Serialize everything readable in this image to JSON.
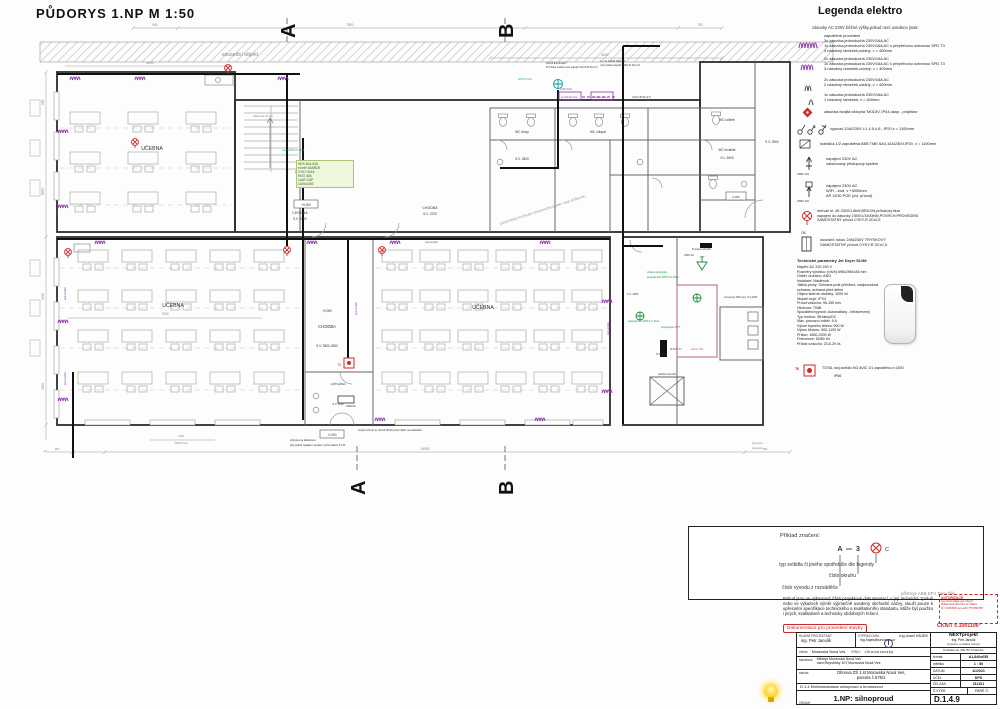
{
  "title": "PŮDORYS 1.NP  M 1:50",
  "plan": {
    "neighbor": "sousední objekt",
    "marker_a": "A",
    "marker_b": "B",
    "rooms": {
      "ucebna": "UČEBNA",
      "chodba": "CHODBA",
      "sv3300": "S.V. 3300",
      "sv3700": "S.V. 3700",
      "sv3839": "S.V. 3800-3900",
      "sv3000": "S.V. 3000",
      "sv2800": "S.V. 2800",
      "sv2600": "S.v. 2600",
      "sv2500": "S.V. 2500",
      "sv4000": "S.V. 4000",
      "wc_divky": "WC dívky",
      "wc_chlapci": "WC chlapci",
      "wc_ucitele": "WC učitelé",
      "wc_invalide": "WC invalidé",
      "umyvarna": "UMÝVÁRNA",
      "sklad": "sklad pod schody",
      "sachta": "šachta rozvodů",
      "ailona": "Ailona 750",
      "server": "serverový R26 stoj. S.V.2300"
    },
    "levels": {
      "zero": "+0,000",
      "minus": "-0,500",
      "plus": "0,060"
    },
    "notes": {
      "vent": "ODVĚTRÁNÍ POTRUBÍ VZDUCHOTECHNIKY NAD STŘECHU",
      "vana": "vana HDTV-U 16x2",
      "hds": "HDS 40A-63A\nel.měř 40A/B/3f\nCYKY 5x16\nHDO 40A\n1xAP-CAP\n1100x1400",
      "sup1": "přívod kontinuální",
      "sup2": "WT těles světel,nově napojit C16/1-B 3Cx1,5",
      "sup3": "1 + 2x 0,6kW žárovka",
      "sup4": "nový kabel,napojit C16/1-B 3Cx1,5",
      "aod": "AOD: 10A",
      "boxa": "el.ohřívač zás.",
      "boxb": "ohřívač zás.",
      "cyky": "C16/1-B 3Cx2,5",
      "hstv": "HSTV-U1x4",
      "ekv1": "ekvipot.přípojnice",
      "posp": "pospojování R/STV-U 16x2",
      "prop": "propojovací VZT",
      "vzt": "VZT",
      "rtop": "R-topení ohradit",
      "v230": "230V AC",
      "rkot": "R-KOT 17",
      "pod": "pod omítku",
      "t6": "T6",
      "z230": "230/16A",
      "bot1": "stropní přívod 1x přívod 3P/32,před odtah vent.kabelům",
      "bot2": "příprava na kabelovou",
      "bot3": "přip.pokud napájení spodem nutno kabely 5,0 B",
      "bot4": "přenosné",
      "bot5": "přepojení"
    },
    "dims": {
      "d900": "900",
      "d7800": "7800",
      "d700": "700",
      "d8400": "8400",
      "d8000": "8000",
      "d8050": "8050",
      "d3450": "3450",
      "d5900": "5900",
      "d7000": "7000",
      "d1650": "1650",
      "d22350": "22350 (NS)",
      "d950": "950",
      "d16950": "16950"
    }
  },
  "legend": {
    "title": "Legenda elektro",
    "subtitle": "zásuvky AC 230V běžné výšky,pokud není uvedeno jinak:",
    "i1": "zapuštěné provedení\n3x zásuvka jednoduchá 230V/16A AC\n1x zásuvka jednoduchá 230V/16A AC s přepěťovou ochranou SPD T3\n4 násobný rámeček,odolný, v = 400mm",
    "i2": "2x zásuvka jednoduchá 230V/16A AC\n1x zásuvka jednoduchá 230V/16A AC s přepěťovou ochranou SPD T3\n3-násobný rámeček,odolný, v = 400mm",
    "i3": "2x zásuvka jednoduchá 230V/16A AC\n2 násobný rámeček,odolný, v = 400mm",
    "i4": "1x zásuvka jednoduchá 230V/16A AC\n1 násobný rámeček, v = 400mm",
    "i5": "zásuvka dvojitá sklopná 'MODIV',IP44,okap - projektor",
    "i6": "vypínač 10A/230V č.1,č.5,č.6 ;  IP20,v = 1100mm",
    "i7": "krabička 1/2 zapuštěná ABB TME 6A4,10A/230V,IP20, v = 1100mm",
    "i8": "napájení 230V AC\nzálohovaný přístupový systém",
    "i9": "napájení 230V AC\nWIFI - bod, v +3000mm\nAP-X230 POE (zvl. přívod)",
    "v230": "230V AC",
    "i10": "ohřívač el. 4K 230V/1,8kW,BRILON,průtokový fáze\nnapojení do zásuvky 230V/1/1400MM,POVRCH.PROVEDENÍ\nSAMOSTATNÝ přívod CYKY-R 3Cx2,5",
    "ok": "OK",
    "i11": "osoušeč rukou 24N/230V TRYSKOVÝ\nSAMOSTATNÝ přívod CYKY-R 3Cx2,5",
    "tp_title": "Technické parametry Jet Dryer SLIM:",
    "tp": "Napětí: AC 220-240 V\nRozměry výrobku: (v/š/h) 698x296x184 mm\nOdběr vzduchu: ANO\nInstalace: Nástěnná\nJističe,prvky: Ochrana proti přetížení, nadproudová ochrana, ochrana před dětmi\nObjem sběrné nádržky: 1000 ml\nStupeň krytí: IPX4\nProud vzduchu: 95-155 m/s\nHlučnost: 70dB\nSpouštění/vypnutí: Automaticky - infračervený\nTyp motoru: Střídavý/DC\nMax. provozní odběr: 9 A\nVýkon topného tělesa: 900 W\nVýkon Motoru: 900-1100 W\nPříkon: 1650-2000 W\nFrekvence: 50/60 Hz\nPrůtok vzduchu: 23,5-29 l/s",
    "t6": "T6",
    "i12": "TOTAL  stoj.svítidlo  NG AVIC 1/1 zapuštěno,v=1500",
    "i12b": "IP66"
  },
  "example": {
    "title": "Příklad značení:",
    "ma": "A",
    "mn": "3",
    "mc": "C",
    "l1": "typ svítidla či jiného spotřebiče dle legendy",
    "l2": "číslo okruhu",
    "l3": "číslo vývodu z rozváděče",
    "foot": "přístroje ABB EPJ Time bílé"
  },
  "footer": {
    "disclaimer": "Pokud jsou ve výkresové části projektové dokumentací, v její technické zprávě nebo ve výkazech výměr výjimečně uvedeny obchodní názvy, slouží pouze k upřesnění specifikace technického a kvalitativního standartu. Může být použito i jiných, kvalitativně a technicky obdobných řešení.",
    "stamp": "Dokumentace pro provedení stavby",
    "aut_title": "AUTORIZACE",
    "aut_lines": "Ing.Josef Hájek,aut.inženýr\nMikulovská 404,691 42 Valtice\nIČ: 15053532  tel:+420 775 888 887",
    "ckait": "ČKAIT č.1001106*"
  },
  "titleblock": {
    "r1c1l": "HLAVNÍ PROJEKTANT",
    "r1c1v": "ing. Petr Janulík",
    "r1c2l": "VYPRACOVAL",
    "r1c2v": "Ing.Josef HÁJEK",
    "r1c2e": "ing.hajek@seznam.cz",
    "r2l": "město",
    "r2v": "Moravská Nová Ves",
    "r2l2": "KRAJ:",
    "r2v2": "Jihomoravský",
    "r3l": "stavebník",
    "r3v": "Městys Moravská Nová Ves\nnám.Republiky 107,Moravská Nová Ves",
    "r4l": "stavba",
    "r4v": "Obnova ZŠ 1.st Moravská Nová Ves,\nparcela č.675/1",
    "r5": "D.1.4 Elektroinstalace silnoproud a hromosvod",
    "r6l": "OBSAH",
    "r6v": "1.NP: silnoproud",
    "firm": "NEXTprojekt",
    "person": "Ing. Petr Janulík",
    "desc": "projekce a statika staveb",
    "addr": "Kostická 10, 691 53 Tvrdonice",
    "f_l": "formát",
    "f_v": "A1,840x655",
    "m_l": "měřítko",
    "m_v": "1 : 50",
    "d_l": "DATUM",
    "d_v": "11/2021",
    "u_l": "ÚČEL",
    "u_v": "DPS",
    "z_l": "ČÍS.ZAK.",
    "z_v": "211101",
    "v_l": "Č.VÝKR.",
    "p_l": "PARÉ Č.",
    "no": "D.1.4.9"
  }
}
